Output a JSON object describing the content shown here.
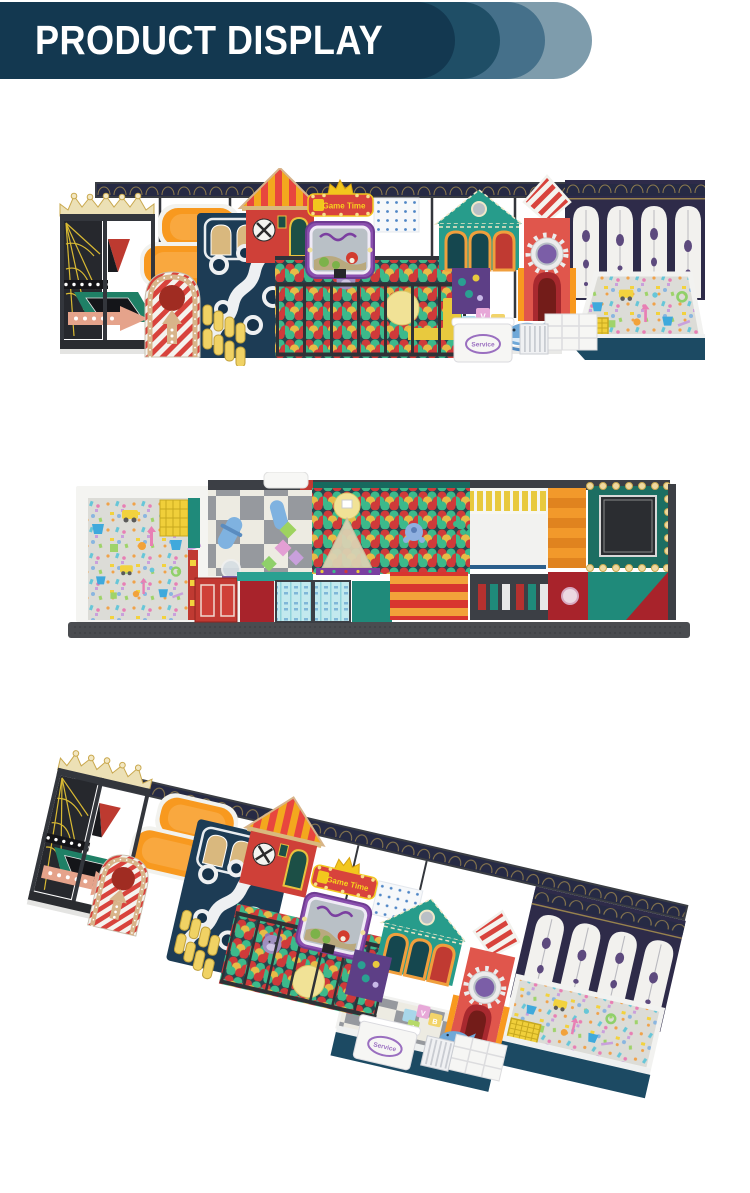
{
  "header": {
    "title": "PRODUCT DISPLAY"
  },
  "palette": {
    "banner_navy": "#133850",
    "banner_echo_dark": "#1f4e66",
    "banner_echo_mid": "#45708a",
    "banner_echo_light": "#7e9cac",
    "frame_charcoal": "#3a3d43",
    "wall_navy": "#262a44",
    "panel_navy": "#1d3c55",
    "arch_wall_purple": "#2e2b49",
    "platform_teal": "#1c4a63",
    "orange": "#f8991f",
    "house_red": "#cf4038",
    "crimson": "#a8232b",
    "teal_house": "#279c8b",
    "deck_green": "#1f8066",
    "ball_red": "#cf3a3a",
    "ball_green": "#3cb98b",
    "ball_yellow": "#e7bb47",
    "crown_cream": "#ece0b5",
    "gold": "#c9a84e",
    "confetti_base": "#dcdcd7",
    "foam_cream": "#edebe2",
    "foam_gray": "#96999e",
    "screen_purple": "#8a4fae",
    "service_purple": "#9a6fc0"
  },
  "figures": {
    "front_view": {
      "game_sign": "Game Time",
      "service_label": "Service",
      "block_letters": {
        "a": "A",
        "v": "V",
        "b": "B"
      }
    },
    "top_view": {},
    "perspective_view": {
      "game_sign": "Game Time",
      "service_label": "Service",
      "block_letters": {
        "a": "A",
        "v": "V",
        "b": "B"
      }
    }
  }
}
